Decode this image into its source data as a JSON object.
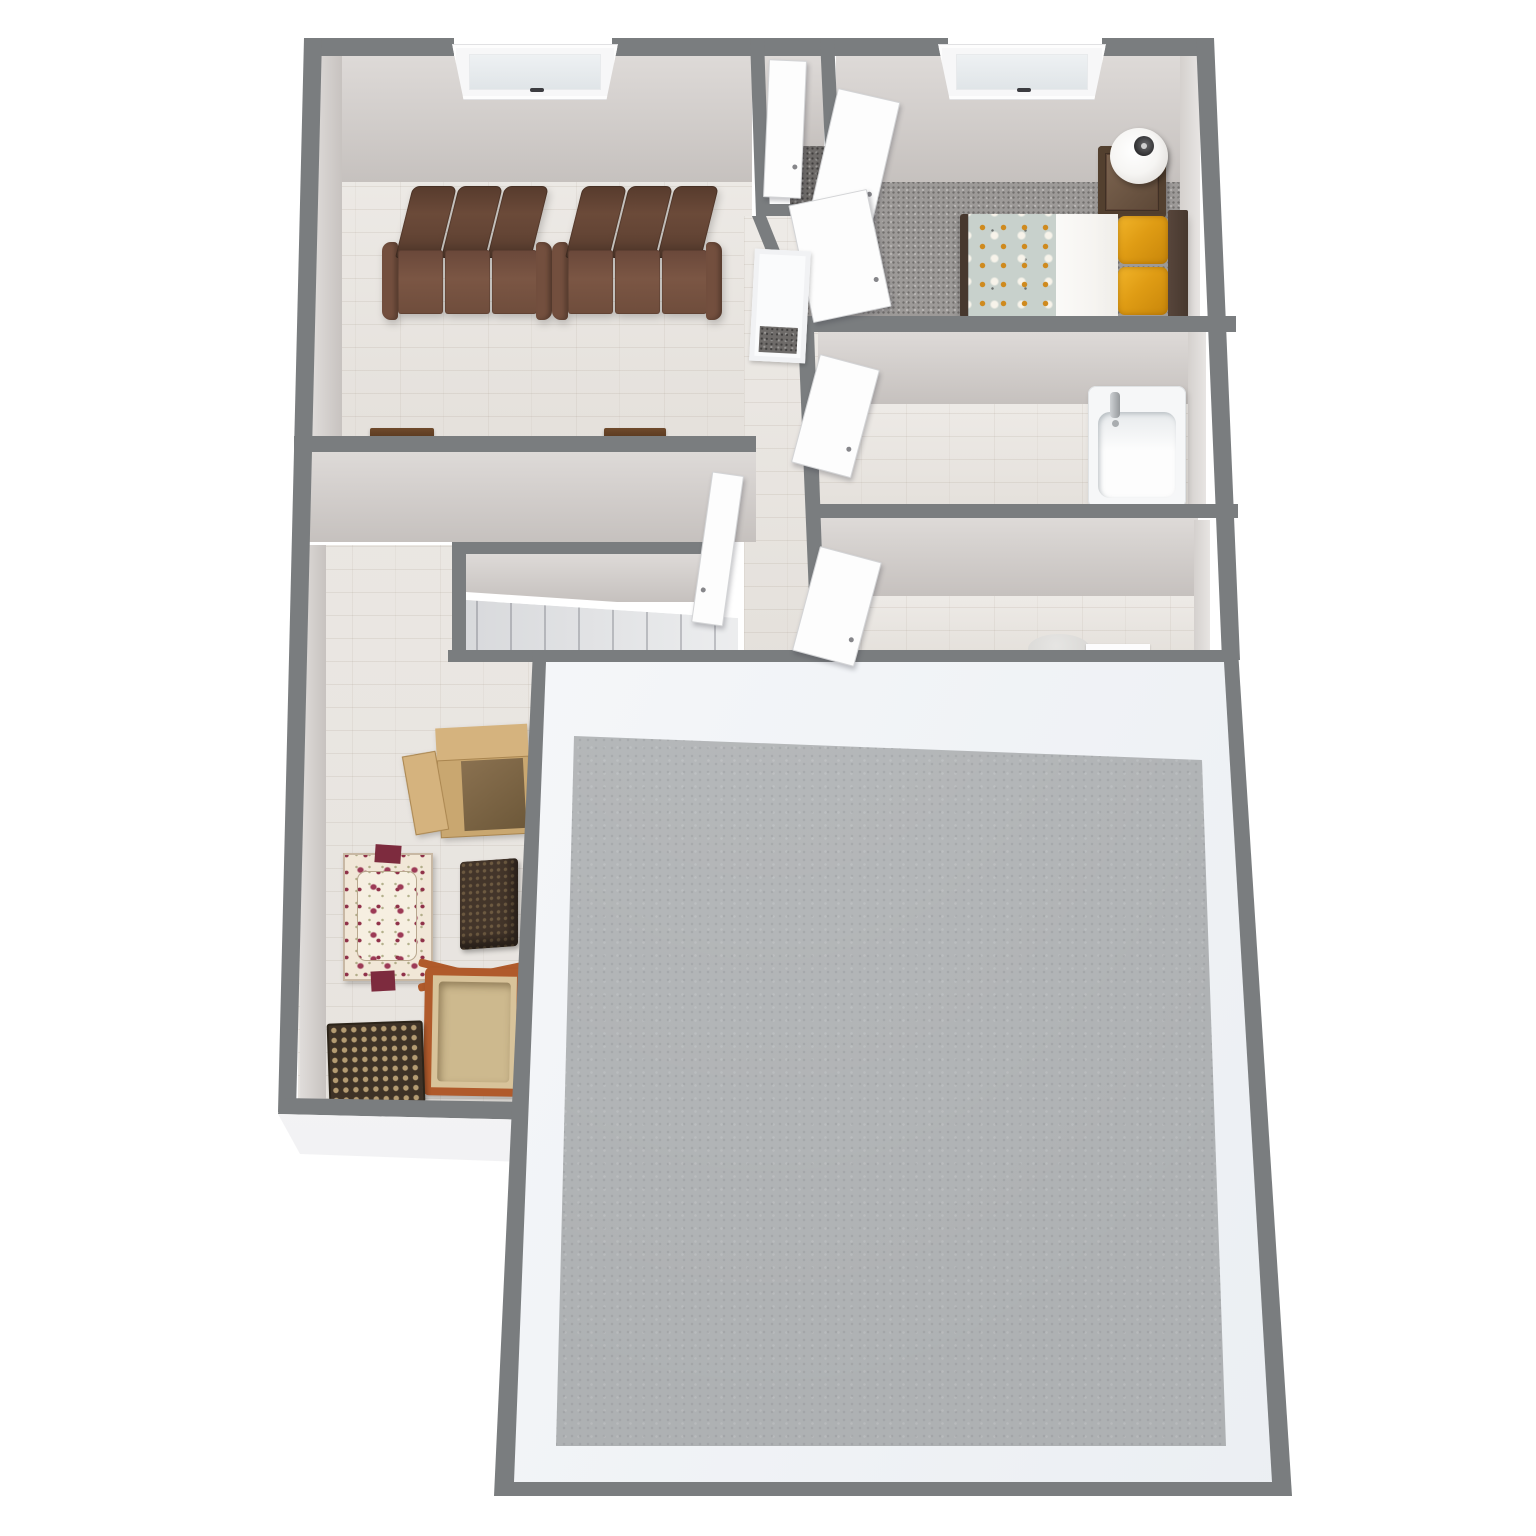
{
  "scene": {
    "type": "3d-floor-plan-render",
    "view": "top-down dollhouse view, no text labels visible",
    "background": "#ffffff"
  },
  "palette": {
    "background": "#ffffff",
    "wall_cap": "#7a7d7f",
    "wall_face": "#d2cdca",
    "wall_face_light": "#ddd9d6",
    "wood_floor": "#e9e5e0",
    "carpet": "#9d9a98",
    "carpet_dark": "#6e6b69",
    "concrete": "#aeb1b3",
    "door_white": "#fdfdfd",
    "sofa_back": "#6b4a39",
    "sofa_seat": "#7b5644",
    "sofa_arm": "#734f3e",
    "bed_sheet": "#f6f4f1",
    "pillow_a": "#df9c14",
    "pillow_b": "#c8860a",
    "duvet_base": "#c8d1cc",
    "duvet_orange": "#cf8a1e",
    "headboard": "#47382e",
    "nightstand": "#5c4536",
    "lamp_white": "#f6f5f3",
    "tub_white": "#f6f7f8",
    "toilet_gray": "#d8d7d4",
    "cardboard_a": "#c9a770",
    "cardboard_b": "#d5b37e",
    "cardboard_inner": "#8a7150",
    "chair_base": "#f1e7d7",
    "chair_rose": "#9c3a56",
    "chair_trim": "#7d2b3e",
    "ottoman_a": "#43352a",
    "ottoman_dot": "#6d5a41",
    "basket_frame": "#b05a2b",
    "basket_canvas": "#d8c39a",
    "mat_a": "#3e3226",
    "mat_dot": "#b59c72",
    "stair_white": "#f4f5f6"
  },
  "rooms": [
    {
      "name": "living-room",
      "floor": "whitewashed wood plank tile",
      "features": [
        "window in top wall",
        "two brown three-seat theater sofas against top wall",
        "two dark wood wall consoles at bottom wall"
      ]
    },
    {
      "name": "bedroom",
      "floor": "gray speckled carpet",
      "features": [
        "window in top wall",
        "bed with dark headboard, white sheet, two orange pillows, patterned duvet",
        "dark wood nightstand",
        "white sphere table lamp",
        "two white swing doors"
      ]
    },
    {
      "name": "closet-nook",
      "floor": "dark gray carpet",
      "features": [
        "white door panel"
      ]
    },
    {
      "name": "hallway",
      "floor": "whitewashed wood plank tile",
      "features": [
        "white linen closet niche",
        "white swing door to living room"
      ]
    },
    {
      "name": "bathroom",
      "floor": "whitewashed wood plank tile",
      "features": [
        "white bathtub with chrome faucet",
        "white swing door"
      ]
    },
    {
      "name": "wc-room",
      "floor": "whitewashed wood plank tile",
      "features": [
        "toilet partly hidden by wall",
        "white counter strip",
        "white swing door"
      ]
    },
    {
      "name": "staircase",
      "features": [
        "white stairs descending to the left inside walled enclosure"
      ]
    },
    {
      "name": "storage-room",
      "floor": "whitewashed wood plank tile",
      "features": [
        "open cardboard box",
        "floral armchair",
        "dark wicker ottoman",
        "wood-frame canvas basket",
        "dark woven mat"
      ]
    },
    {
      "name": "garage",
      "floor": "gray concrete",
      "features": [
        "white interior wall faces",
        "gray wall caps"
      ]
    }
  ],
  "counts": {
    "windows": 2,
    "white_doors": 7,
    "sofa_seats_per_sofa": 3,
    "orange_pillows": 2
  }
}
